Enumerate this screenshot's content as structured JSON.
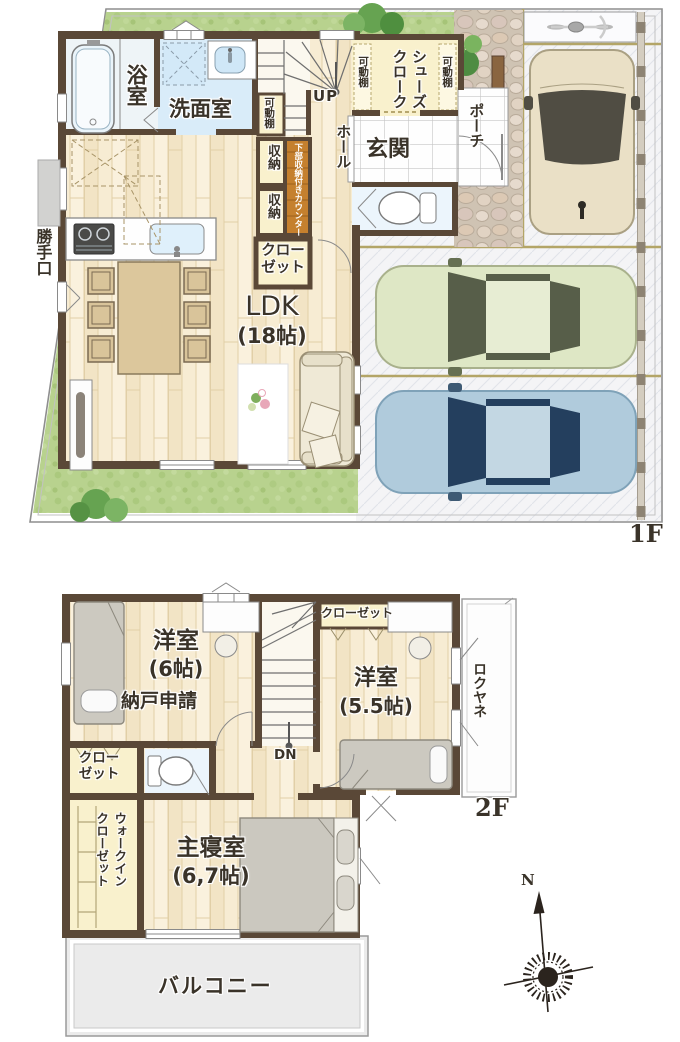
{
  "floor1": {
    "floor_label": "1F",
    "ldk_name": "LDK",
    "ldk_size": "(18帖)",
    "bath": "浴室",
    "washroom": "洗面室",
    "stairs_up": "UP",
    "hall": "ホール",
    "movable_shelf": "可動棚",
    "shoes_cloak": "シューズクローク",
    "entrance": "玄関",
    "porch": "ポーチ",
    "storage": "収納",
    "counter": "下部収納付きカウンター",
    "closet": "クローゼット",
    "back_door": "勝手口"
  },
  "floor2": {
    "floor_label": "2F",
    "bedroom_a_name": "洋室",
    "bedroom_a_size": "(6帖)",
    "bedroom_a_note": "納戸申請",
    "closet_a": "クローゼット",
    "bedroom_b_name": "洋室",
    "bedroom_b_size": "(5.5帖)",
    "flat_roof": "ロクヤネ",
    "stairs_down": "DN",
    "closet_b": "クローゼット",
    "walk_in_closet": "ウォークインクローゼット",
    "master_bedroom_name": "主寝室",
    "master_bedroom_size": "(6,7帖)",
    "balcony": "バルコニー"
  },
  "compass": {
    "north": "N"
  },
  "palette": {
    "wall": "#5a4837",
    "wood_floor": "#f6ead0",
    "closet_fill": "#f9f1cd",
    "counter_wood": "#c5802e",
    "water_blue": "#d9ecf9",
    "grass": "#b8d28e",
    "driveway": "#f4f4f6",
    "car_cream": "#eae0c6",
    "car_green": "#dee7c5",
    "car_blue": "#b0cbdc"
  }
}
